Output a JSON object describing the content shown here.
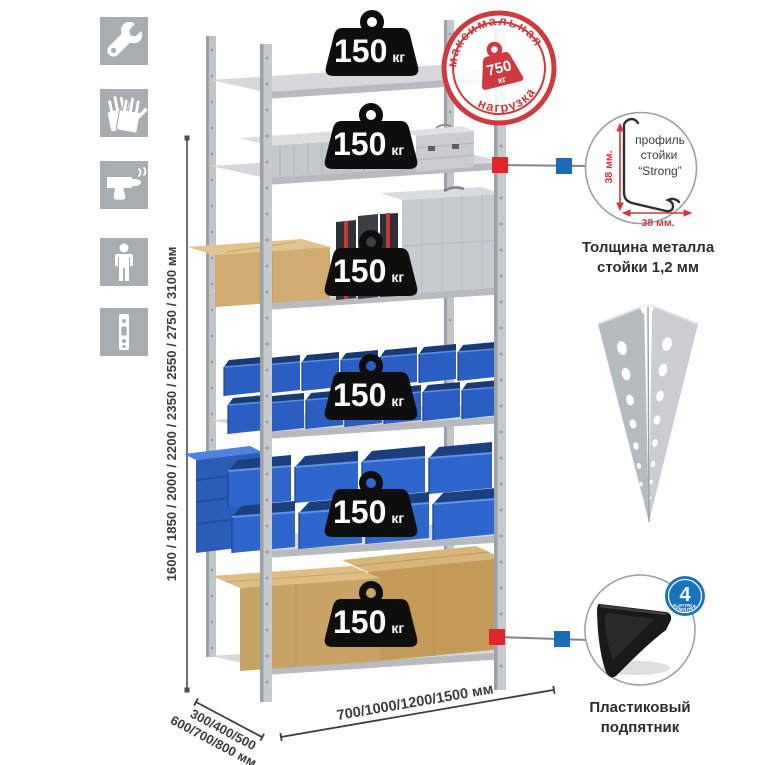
{
  "tools_icons": {
    "items": [
      {
        "name": "wrench"
      },
      {
        "name": "work-gloves"
      },
      {
        "name": "power-drill"
      },
      {
        "name": "assembler-person"
      },
      {
        "name": "perforated-post"
      }
    ]
  },
  "dimensions": {
    "height_options_mm": "1600 / 1850 / 2000 / 2200 / 2350 / 2550 / 2750 / 3100 мм",
    "depth_options_line1": "300/400/500",
    "depth_options_line2": "600/700/800 мм",
    "width_options_mm": "700/1000/1200/1500 мм"
  },
  "rack": {
    "shelf_loads": [
      {
        "value": "150",
        "unit": "кг"
      },
      {
        "value": "150",
        "unit": "кг"
      },
      {
        "value": "150",
        "unit": "кг"
      },
      {
        "value": "150",
        "unit": "кг"
      },
      {
        "value": "150",
        "unit": "кг"
      },
      {
        "value": "150",
        "unit": "кг"
      }
    ]
  },
  "max_load_stamp": {
    "arc_top": "максимальная",
    "arc_bottom": "нагрузка",
    "weight_value": "750",
    "weight_unit": "кг"
  },
  "post_profile": {
    "line1": "профиль",
    "line2": "стойки",
    "line3": "“Strong”",
    "vertical_dim": "38 мм.",
    "horizontal_dim": "38 мм.",
    "caption1": "Толщина металла",
    "caption2": "стойки 1,2 мм"
  },
  "foot_pad": {
    "badge_count": "4",
    "badge_small": "штуки",
    "badge_arc": "в комплекте",
    "caption1": "Пластиковый",
    "caption2": "подпятник"
  },
  "colors": {
    "stamp_red": "#cf3a40",
    "marker_red": "#e0252b",
    "marker_blue": "#1a6cb8",
    "icon_gray": "#a8adb2",
    "bin_blue": "#2e66cc",
    "dim_text": "#383d42"
  }
}
